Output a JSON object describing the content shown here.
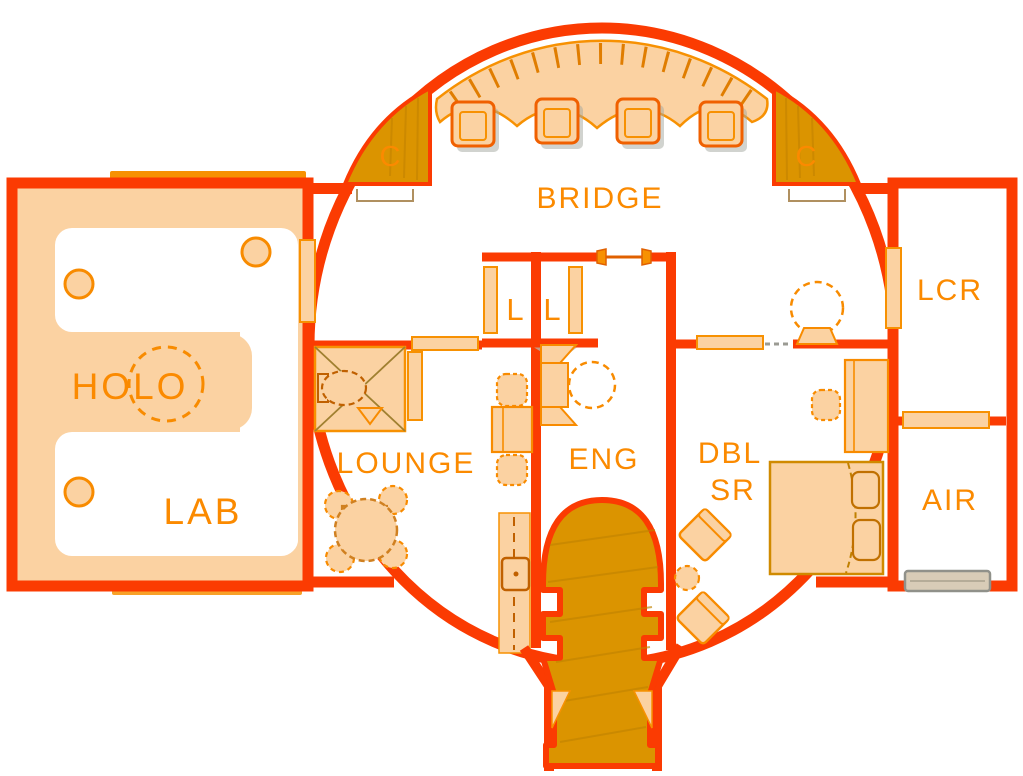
{
  "rooms": {
    "bridge": {
      "label": "BRIDGE"
    },
    "holo": {
      "label": "HOLO"
    },
    "lab": {
      "label": "LAB"
    },
    "lounge": {
      "label": "LOUNGE"
    },
    "eng": {
      "label": "ENG"
    },
    "dbl_sr": {
      "line1": "DBL",
      "line2": "SR"
    },
    "lcr": {
      "label": "LCR"
    },
    "air": {
      "label": "AIR"
    }
  },
  "markers": {
    "closet_left": "C",
    "closet_right": "C",
    "locker_left": "L",
    "locker_right": "L"
  },
  "palette": {
    "wall_red": "#fb3b02",
    "floor_peach": "#fbd2a2",
    "outline_orange": "#f79102",
    "dark_gold": "#db9400",
    "gold_hatch": "#c28200",
    "label_orange": "#fb8a00",
    "airlock_door_tan": "#d8ccb7",
    "airlock_door_gray": "#90918a",
    "shadow_gray": "#a3a89f",
    "background": "#ffffff"
  }
}
